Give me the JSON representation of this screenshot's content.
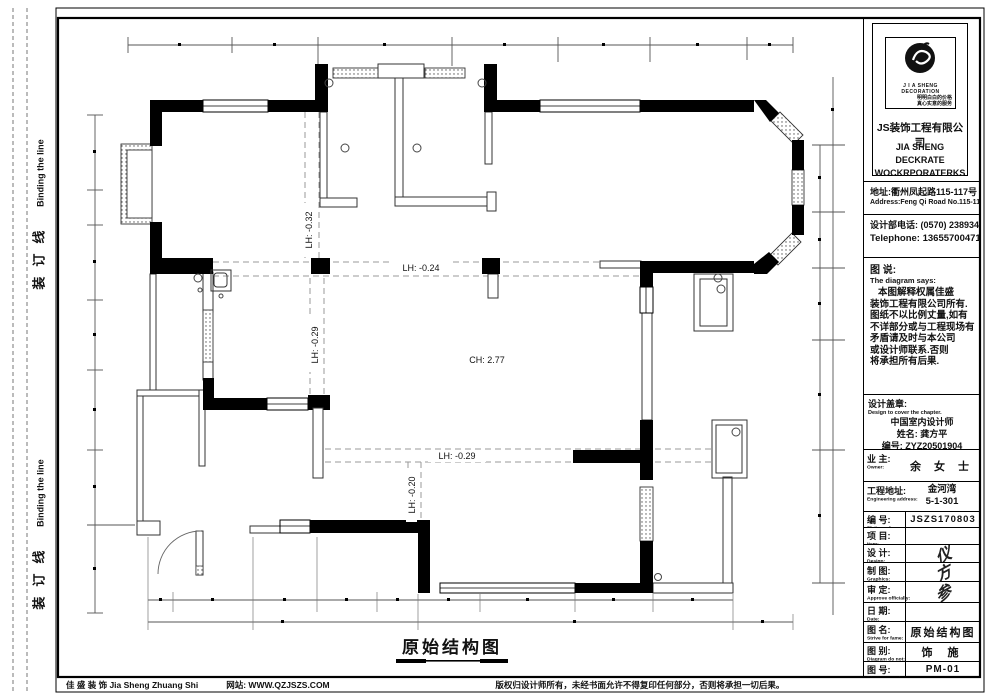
{
  "binding": {
    "label_cn": "装",
    "label_cn2": "订",
    "label_cn3": "线",
    "label_en": "Binding the line"
  },
  "plan": {
    "title": "原始结构图",
    "labels": {
      "lh_top_vertical": "LH: -0.32",
      "lh_mid_horizontal": "LH: -0.24",
      "lh_mid_vertical": "LH: -0.29",
      "ceiling_height": "CH: 2.77",
      "lh_low_horizontal": "LH: -0.29",
      "lh_low_vertical": "LH: -0.20"
    }
  },
  "title_block": {
    "logo": {
      "brand_en_small": "J I A  SHENG  DECORATION",
      "slogan_line1": "明明白白的价格",
      "slogan_line2": "真心实意的服务",
      "company_cn": "JS装饰工程有限公司",
      "company_en_line1": "JIA SHENG DECKRATE",
      "company_en_line2": "WOCKRPORATERKS"
    },
    "address_cn": "地址:衢州凤起路115-117号",
    "address_en": "Address:Feng Qi Road No.115-117",
    "phone_cn": "设计部电话: (0570) 2389348",
    "phone_en": "Telephone: 13655700471",
    "notes": {
      "title_cn": "图 说:",
      "title_en": "The diagram says:",
      "lines": [
        "本图解释权属佳盛",
        "装饰工程有限公司所有.",
        "图纸不以比例丈量,如有",
        "不详部分或与工程现场有",
        "矛盾请及时与本公司",
        "或设计师联系.否则",
        "将承担所有后果."
      ]
    },
    "stamp": {
      "title_cn": "设计盖章:",
      "title_en": "Design to cover the chapter.",
      "line1": "中国室内设计师",
      "name": "姓名: 龚方平",
      "number": "编号: ZYZ20501904"
    },
    "owner": {
      "label_cn": "业 主:",
      "label_en": "Owner:",
      "value": "余 女 士"
    },
    "site": {
      "label_cn": "工程地址:",
      "label_en": "Engineering address:",
      "value_line1": "金河湾",
      "value_line2": "5-1-301"
    },
    "rows": [
      {
        "label_cn": "编 号:",
        "label_en": "Plait number:",
        "value": "JSZS170803"
      },
      {
        "label_cn": "项 目:",
        "label_en": "Item:",
        "value": ""
      },
      {
        "label_cn": "设 计:",
        "label_en": "Design:",
        "value": "仪"
      },
      {
        "label_cn": "制 图:",
        "label_en": "Graphics:",
        "value": "方"
      },
      {
        "label_cn": "审 定:",
        "label_en": "Approve officially:",
        "value": "参"
      },
      {
        "label_cn": "日 期:",
        "label_en": "Date:",
        "value": ""
      },
      {
        "label_cn": "图 名:",
        "label_en": "Strive for fame:",
        "value": "原始结构图"
      },
      {
        "label_cn": "图 别:",
        "label_en": "Diagram do not:",
        "value": "饰 施"
      },
      {
        "label_cn": "图 号:",
        "label_en": "Diagram number:",
        "value": "PM-01"
      }
    ]
  },
  "footer": {
    "company": "佳 盛 装 饰 Jia Sheng Zhuang Shi",
    "website": "网站: WWW.QZJSZS.COM",
    "copyright": "版权归设计师所有，未经书面允许不得复印任何部分，否则将承担一切后果。"
  }
}
